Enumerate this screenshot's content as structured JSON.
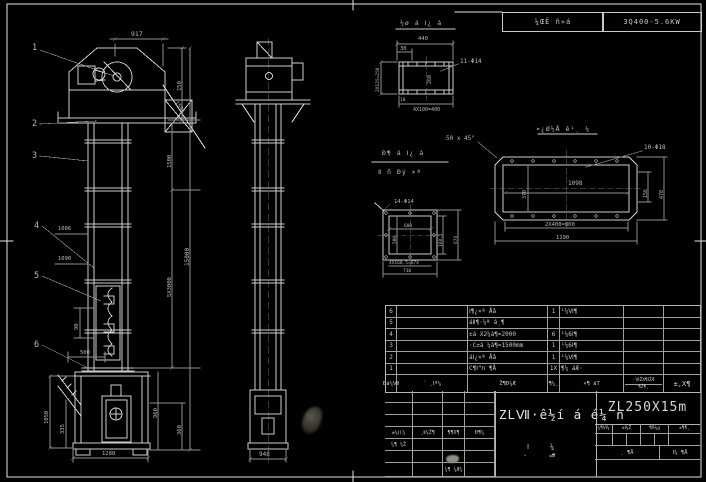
{
  "header_band": {
    "cell_left": "¼ŒÊ ñ»á",
    "cell_right": "3Q400-5.6KW"
  },
  "front_view": {
    "callouts": {
      "c1": "1",
      "c2": "2",
      "c3": "3",
      "c4": "4",
      "c5": "5",
      "c6": "6"
    },
    "dims": {
      "top_width": "917",
      "head_height": "150",
      "stay_rod": "1595",
      "upper_section": "1500",
      "mid_sections": "5X3000",
      "total_height": "15000",
      "boot_right_a": "960",
      "boot_right_b": "360",
      "left_a": "1086",
      "left_b": "1090",
      "bucket_pitch": "90",
      "bucket_len": "500",
      "boot_left_a": "1050",
      "boot_left_b": "335",
      "boot_width": "1280"
    }
  },
  "side_view": {
    "dims": {
      "base_width": "948"
    }
  },
  "detail_head_section": {
    "title": "½ø á Ⅰ¿ á",
    "dims": {
      "width": "440",
      "offset": "30",
      "depth": "260",
      "left": "2X125=250",
      "holes": "11-Φ14",
      "pitch": "4X100=400",
      "corner": "10"
    }
  },
  "detail_flange": {
    "title_top": "Ð¶ á Ⅰ¿ á",
    "title_bottom": "Ⅱ ñ Ðý ×ª",
    "dims": {
      "holes": "14-Φ14",
      "inner_w": "600",
      "inner_h": "500",
      "right_inner": "168.5",
      "right_outer": "674",
      "pitch": "4X168.5=674",
      "overall": "730"
    }
  },
  "detail_spout": {
    "title": "¤¿Ø½Å ê¹¸ ¼",
    "chamfer": "50 x 45°",
    "dims": {
      "holes": "10-Φ18",
      "inner": "1098",
      "left": "370",
      "right_inner": "156",
      "right_outer": "470",
      "pitch": "2X400=800",
      "overall": "1190"
    }
  },
  "bom": {
    "rows": [
      {
        "no": "6",
        "code": "",
        "name": "Ⅰ¶¿×ª Åâ",
        "qty": "1",
        "material": "¹¼Ⅵ¶",
        "note": ""
      },
      {
        "no": "5",
        "code": "",
        "name": "áⅡ¶·¼ª á¸¶",
        "qty": "",
        "material": "",
        "note": ""
      },
      {
        "no": "4",
        "code": "",
        "name": "±á X2¼á¶=2000",
        "qty": "6",
        "material": "¹¼6Ⅰ¶",
        "note": ""
      },
      {
        "no": "3",
        "code": "",
        "name": "·C±á ¼á¶=1500mm",
        "qty": "1",
        "material": "¹¼6Ⅰ¶",
        "note": ""
      },
      {
        "no": "2",
        "code": "",
        "name": "áⅠ¿×ª Åâ",
        "qty": "1",
        "material": "¹¼Ⅵ¶",
        "note": ""
      },
      {
        "no": "1",
        "code": "",
        "name": "C¶Ⅰʺת ¶Å",
        "qty": "1X",
        "material": "¶¼ áÆ·",
        "note": ""
      }
    ],
    "header": {
      "no": "Ðá¼Ⅶ",
      "code": "´ ¸Ⅰº¼",
      "name": "Ž¶Ð¼Æ",
      "qty": "¶¼¸",
      "material": "×¶ áT",
      "weight_top": "·ⅥŽX¶ⅠŽÆ",
      "weight_bottom": "¶Ž¶¸",
      "note": "±,X¶"
    }
  },
  "title_block": {
    "approvals_row": [
      "±¼Ⅰ(¼",
      "¸Ⅱ¼Ž¶",
      "¶¶X¶",
      "Ð¶¼"
    ],
    "design_label": "¼¶ ¼Ž",
    "check_label": "¼¶ ¼Æ¼",
    "drawing_title": "ZLⅦ·ê½í á é¼ ñ",
    "model": "ZL250X15m",
    "scale_cells": [
      "¼¶Ⅵ¼",
      "±Ⅰ¼Ž",
      "¶Å¼g",
      "±¶¶¸"
    ],
    "sheet_left": "¸ ¶Å",
    "sheet_right": "Ⅰ¼ ¶Å",
    "vert_label_a": "Ⅰ¸",
    "vert_label_b": "¼¶"
  }
}
